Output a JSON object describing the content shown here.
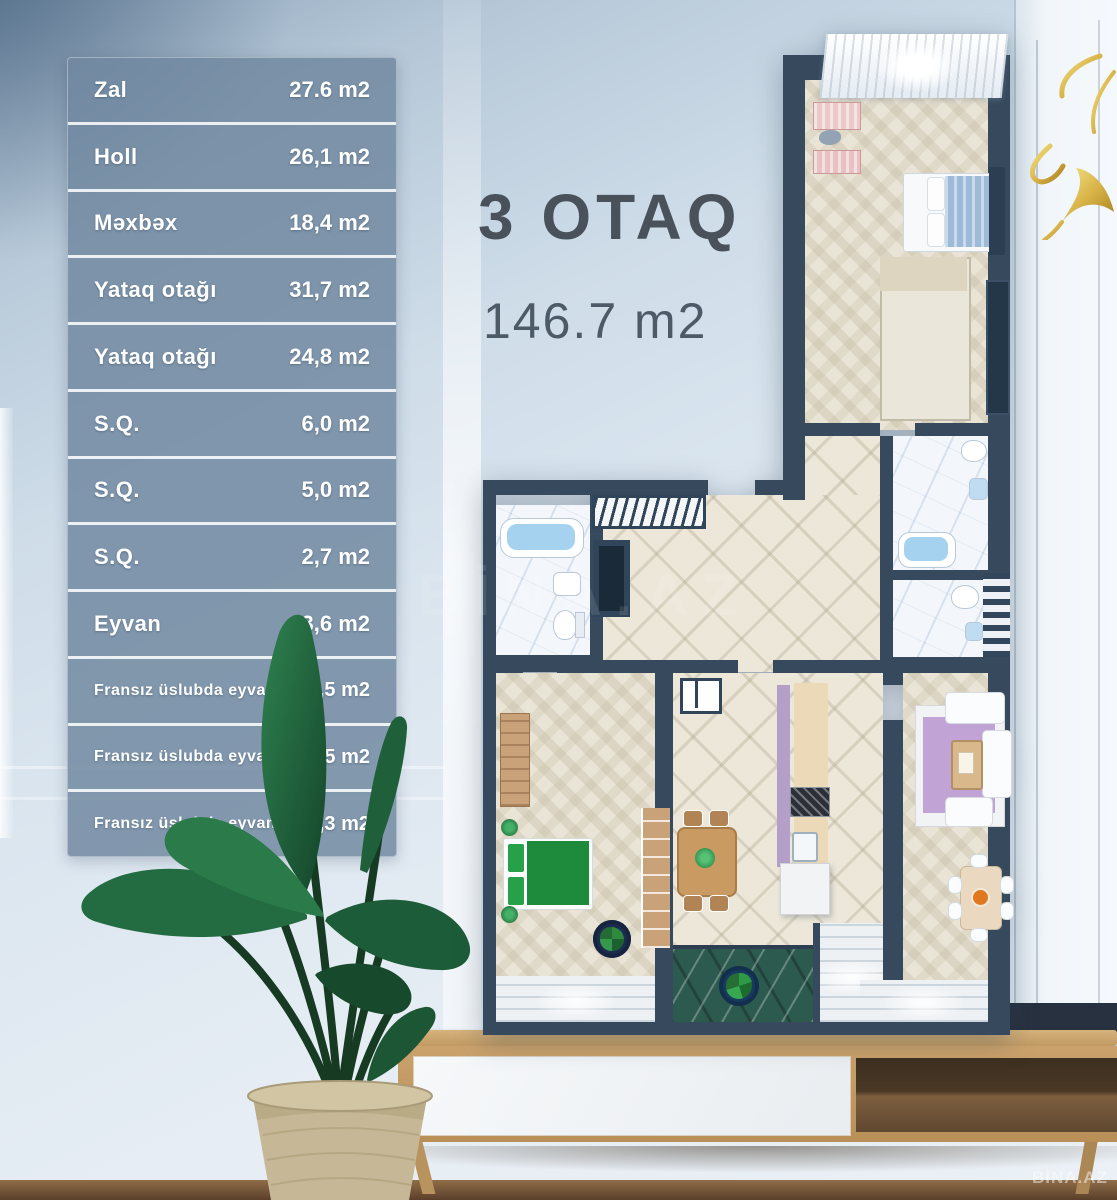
{
  "header": {
    "title": "3 OTAQ",
    "subtitle": "146.7 m2"
  },
  "area_table": {
    "rows": [
      {
        "label": "Zal",
        "value": "27.6 m2"
      },
      {
        "label": "Holl",
        "value": "26,1 m2"
      },
      {
        "label": "Məxbəx",
        "value": "18,4 m2"
      },
      {
        "label": "Yataq otağı",
        "value": "31,7 m2"
      },
      {
        "label": "Yataq otağı",
        "value": "24,8 m2"
      },
      {
        "label": "S.Q.",
        "value": "6,0 m2"
      },
      {
        "label": "S.Q.",
        "value": "5,0 m2"
      },
      {
        "label": "S.Q.",
        "value": "2,7 m2"
      },
      {
        "label": "Eyvan",
        "value": "3,6 m2"
      },
      {
        "label": "Fransız üslubda eyvan",
        "value": "0,5 m2"
      },
      {
        "label": "Fransız üslubda eyvan",
        "value": "0,5 m2"
      },
      {
        "label": "Fransız üslubda eyvan",
        "value": "0,3 m2"
      }
    ]
  },
  "watermarks": {
    "corner": "BİNA.AZ",
    "center": "BİNA.AZ"
  },
  "colors": {
    "table_row_bg": "#7089a0",
    "title_text": "#49525b",
    "plan_wall": "#36495d",
    "accent_gold": "#d8b44a",
    "bed_green": "#1e8a3c",
    "rug_purple": "#c2a3d6"
  }
}
